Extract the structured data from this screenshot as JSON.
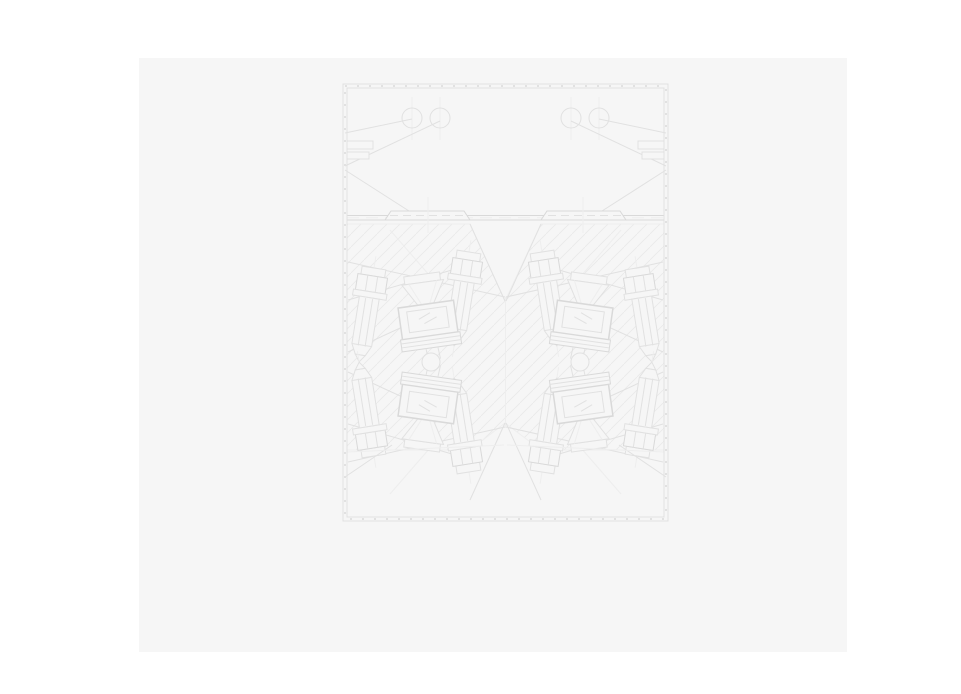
{
  "page": {
    "background": "#ffffff",
    "width": 961,
    "height": 694
  },
  "canvas": {
    "x": 139,
    "y": 58,
    "width": 708,
    "height": 594,
    "background": "#f6f6f6"
  },
  "drawing": {
    "colors": {
      "bg": "#f6f6f6",
      "line": "#e1e1e1",
      "strong": "#d9d9d9",
      "faint": "#eeeeee",
      "hatch": "#eaeaea"
    },
    "axes": {
      "x": 505.5,
      "y": 362
    },
    "hatch_tile": 13,
    "symbols": {
      "bolt": [
        {
          "t": "line",
          "x1": 0,
          "y1": -12,
          "x2": 0,
          "y2": 106,
          "c": "faint",
          "name": "bolt-centerline"
        },
        {
          "t": "rect",
          "x": -12,
          "y": 0,
          "w": 24,
          "h": 8,
          "f": "bg",
          "name": "bolt-cap"
        },
        {
          "t": "rect",
          "x": -15,
          "y": 8,
          "w": 30,
          "h": 16,
          "f": "bg",
          "c": "strong",
          "name": "bolt-head"
        },
        {
          "t": "line",
          "x1": -5,
          "y1": 8,
          "x2": -5,
          "y2": 24,
          "name": "head-facet"
        },
        {
          "t": "line",
          "x1": 5,
          "y1": 8,
          "x2": 5,
          "y2": 24,
          "name": "head-facet"
        },
        {
          "t": "rect",
          "x": -17,
          "y": 24,
          "w": 34,
          "h": 6,
          "f": "bg",
          "name": "bolt-washer"
        },
        {
          "t": "poly",
          "p": [
            [
              -10,
              30
            ],
            [
              10,
              30
            ],
            [
              10,
              78
            ],
            [
              5,
              88
            ],
            [
              -5,
              88
            ],
            [
              -10,
              78
            ]
          ],
          "f": "bg",
          "name": "bolt-shank"
        },
        {
          "t": "line",
          "x1": -3.5,
          "y1": 31,
          "x2": -3.5,
          "y2": 79,
          "name": "thread-line"
        },
        {
          "t": "line",
          "x1": 3.5,
          "y1": 31,
          "x2": 3.5,
          "y2": 79,
          "name": "thread-line"
        },
        {
          "t": "line",
          "x1": -10,
          "y1": 78,
          "x2": 10,
          "y2": 78,
          "name": "chamfer-line"
        },
        {
          "t": "poly",
          "p": [
            [
              -5,
              88
            ],
            [
              5,
              88
            ],
            [
              0,
              95
            ]
          ],
          "f": "bg",
          "name": "bolt-tip"
        }
      ],
      "block": [
        {
          "t": "rect",
          "x": -18,
          "y": -46,
          "w": 36,
          "h": 8,
          "f": "bg",
          "name": "funnel-cap"
        },
        {
          "t": "poly",
          "p": [
            [
              -21,
              -38
            ],
            [
              21,
              -38
            ],
            [
              8,
              -16
            ],
            [
              -8,
              -16
            ]
          ],
          "f": "bg",
          "name": "funnel"
        },
        {
          "t": "line",
          "x1": -14,
          "y1": -38,
          "x2": -4,
          "y2": -16,
          "c": "faint",
          "name": "funnel-inner-line"
        },
        {
          "t": "line",
          "x1": 14,
          "y1": -38,
          "x2": 4,
          "y2": -16,
          "c": "faint",
          "name": "funnel-inner-line"
        },
        {
          "t": "rect",
          "x": -28,
          "y": -16,
          "w": 56,
          "h": 32,
          "f": "bg",
          "c": "strong",
          "sw": 1.5,
          "name": "liner-frame"
        },
        {
          "t": "rect",
          "x": -20,
          "y": -11,
          "w": 40,
          "h": 21,
          "f": "bg",
          "name": "liner-window"
        },
        {
          "t": "line",
          "x1": -9,
          "y1": -2,
          "x2": 3,
          "y2": -7,
          "name": "window-hatch-tick"
        },
        {
          "t": "line",
          "x1": -4,
          "y1": 3,
          "x2": 9,
          "y2": -2,
          "name": "window-hatch-tick"
        },
        {
          "t": "rect",
          "x": -30,
          "y": 16,
          "w": 60,
          "h": 12,
          "f": "bg",
          "c": "strong",
          "name": "plate-stack"
        },
        {
          "t": "line",
          "x1": -30,
          "y1": 20,
          "x2": 30,
          "y2": 20,
          "name": "plate-seam"
        },
        {
          "t": "line",
          "x1": -30,
          "y1": 24,
          "x2": 30,
          "y2": 24,
          "name": "plate-seam"
        },
        {
          "t": "line",
          "x1": -6,
          "y1": 28,
          "x2": -5,
          "y2": 40,
          "name": "stem-line"
        },
        {
          "t": "line",
          "x1": 6,
          "y1": 28,
          "x2": 7,
          "y2": 40,
          "name": "stem-line"
        }
      ],
      "cluster": [
        {
          "t": "line",
          "x1": 348,
          "y1": 262,
          "x2": 505,
          "y2": 297,
          "name": "leader-line"
        },
        {
          "t": "line",
          "x1": 348,
          "y1": 300,
          "x2": 452,
          "y2": 270,
          "name": "leader-line"
        },
        {
          "t": "line",
          "x1": 348,
          "y1": 352,
          "x2": 470,
          "y2": 296,
          "name": "leader-line"
        },
        {
          "t": "line",
          "x1": 390,
          "y1": 230,
          "x2": 430,
          "y2": 276,
          "c": "faint",
          "name": "leader-line"
        },
        {
          "t": "line",
          "x1": 470,
          "y1": 224,
          "x2": 505,
          "y2": 301,
          "name": "hatch-boundary"
        },
        {
          "t": "use",
          "s": "bolt",
          "tx": 374,
          "ty": 268,
          "rot": 9,
          "name": "outer-bolt"
        },
        {
          "t": "use",
          "s": "bolt",
          "tx": 469,
          "ty": 252,
          "rot": 9,
          "name": "inner-bolt"
        },
        {
          "t": "use",
          "s": "block",
          "tx": 428,
          "ty": 320,
          "rot": -8,
          "name": "liner-block"
        }
      ],
      "chamber": [
        {
          "t": "line",
          "x1": 412,
          "y1": 97,
          "x2": 412,
          "y2": 140,
          "c": "faint",
          "name": "hole-centerline"
        },
        {
          "t": "line",
          "x1": 440,
          "y1": 97,
          "x2": 440,
          "y2": 140,
          "c": "faint",
          "name": "hole-centerline"
        },
        {
          "t": "circle",
          "cx": 412,
          "cy": 118,
          "r": 10,
          "name": "hole-circle"
        },
        {
          "t": "circle",
          "cx": 440,
          "cy": 118,
          "r": 10,
          "name": "hole-circle"
        },
        {
          "t": "line",
          "x1": 412,
          "y1": 119,
          "x2": 345,
          "y2": 133,
          "name": "leader-line"
        },
        {
          "t": "line",
          "x1": 440,
          "y1": 121,
          "x2": 345,
          "y2": 166,
          "name": "leader-line"
        },
        {
          "t": "line",
          "x1": 345,
          "y1": 170,
          "x2": 409,
          "y2": 211,
          "name": "leader-line"
        }
      ],
      "plate": [
        {
          "t": "poly",
          "p": [
            [
              385,
              220
            ],
            [
              391,
              211
            ],
            [
              464,
              211
            ],
            [
              470,
              220
            ]
          ],
          "f": "bg",
          "c": "strong",
          "name": "wear-plate"
        },
        {
          "t": "line",
          "x1": 390,
          "y1": 215.5,
          "x2": 465,
          "y2": 215.5,
          "dash": [
            8,
            5
          ],
          "name": "plate-hidden-line"
        },
        {
          "t": "line",
          "x1": 428,
          "y1": 197,
          "x2": 428,
          "y2": 233,
          "c": "faint",
          "name": "plate-centerline"
        }
      ],
      "wallfeature": [
        {
          "t": "rect",
          "x": 347,
          "y": 141,
          "w": 26,
          "h": 8,
          "f": "bg",
          "name": "wall-notch"
        },
        {
          "t": "rect",
          "x": 347,
          "y": 152,
          "w": 22,
          "h": 7,
          "f": "bg",
          "name": "wall-notch"
        },
        {
          "t": "line",
          "x1": 345,
          "y1": 477,
          "x2": 392,
          "y2": 445,
          "name": "leader-line"
        },
        {
          "t": "line",
          "x1": 347,
          "y1": 452,
          "x2": 504,
          "y2": 445,
          "c": "faint",
          "name": "hatch-boundary"
        }
      ]
    },
    "layers": [
      {
        "name": "hatch-band",
        "shapes": [
          {
            "t": "poly",
            "p": [
              [
                347,
                224
              ],
              [
                470,
                224
              ],
              [
                505,
                301
              ],
              [
                541,
                224
              ],
              [
                664,
                224
              ],
              [
                664,
                450
              ],
              [
                541,
                450
              ],
              [
                505,
                423
              ],
              [
                470,
                450
              ],
              [
                347,
                450
              ]
            ],
            "f": "hatchpat",
            "c": "faint",
            "name": "section-hatch"
          }
        ]
      },
      {
        "name": "divider",
        "shapes": [
          {
            "t": "line",
            "x1": 347,
            "y1": 215.5,
            "x2": 664,
            "y2": 215.5,
            "c": "strong",
            "name": "divider-line"
          },
          {
            "t": "line",
            "x1": 347,
            "y1": 220,
            "x2": 664,
            "y2": 220,
            "c": "strong",
            "name": "divider-line"
          },
          {
            "t": "line",
            "x1": 347,
            "y1": 217.8,
            "x2": 664,
            "y2": 217.8,
            "dash": [
              12,
              7
            ],
            "c": "faint",
            "name": "divider-hidden-line"
          },
          {
            "t": "line",
            "x1": 505.5,
            "y1": 297,
            "x2": 505.5,
            "y2": 428,
            "c": "faint",
            "name": "mirror-seam"
          }
        ]
      },
      {
        "symbol": "chamber",
        "m": "",
        "name": "chamber-left"
      },
      {
        "symbol": "chamber",
        "m": "x",
        "name": "chamber-right"
      },
      {
        "symbol": "plate",
        "m": "",
        "name": "plate-left"
      },
      {
        "symbol": "plate",
        "m": "x",
        "name": "plate-right"
      },
      {
        "symbol": "cluster",
        "m": "",
        "name": "cluster-top-left"
      },
      {
        "symbol": "cluster",
        "m": "x",
        "name": "cluster-top-right"
      },
      {
        "symbol": "cluster",
        "m": "y",
        "name": "cluster-bottom-left"
      },
      {
        "symbol": "cluster",
        "m": "xy",
        "name": "cluster-bottom-right"
      },
      {
        "name": "pivots",
        "shapes": [
          {
            "t": "circle",
            "cx": 431,
            "cy": 362,
            "r": 9,
            "f": "bg",
            "name": "pivot-circle"
          },
          {
            "t": "circle",
            "cx": 580,
            "cy": 362,
            "r": 9,
            "f": "bg",
            "name": "pivot-circle"
          }
        ]
      },
      {
        "symbol": "wallfeature",
        "m": "",
        "name": "wall-features-left"
      },
      {
        "symbol": "wallfeature",
        "m": "x",
        "name": "wall-features-right"
      },
      {
        "name": "housing-border",
        "shapes": [
          {
            "t": "rect",
            "x": 345,
            "y": 86,
            "w": 321,
            "h": 433,
            "c": "line",
            "sw": 2,
            "dash": [
              2,
              10
            ],
            "name": "wall-tick-marks"
          },
          {
            "t": "rect",
            "x": 343,
            "y": 84,
            "w": 325,
            "h": 437,
            "name": "outer-border"
          },
          {
            "t": "rect",
            "x": 347,
            "y": 88,
            "w": 317,
            "h": 429,
            "name": "inner-border"
          }
        ]
      }
    ]
  }
}
